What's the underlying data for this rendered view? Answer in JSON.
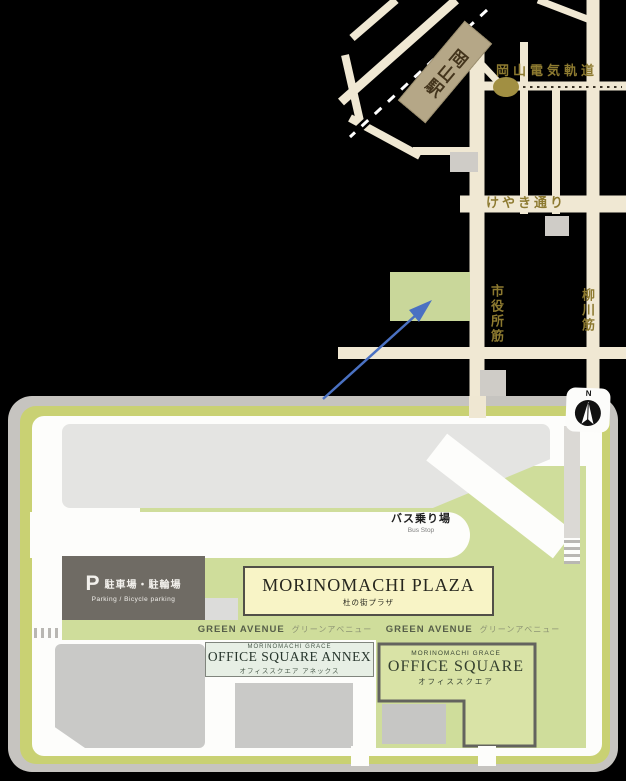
{
  "street_map": {
    "station": "岡山駅",
    "tram_label": "岡山電気軌道",
    "keyaki_street": "けやき通り",
    "shiyakusho_street": "市役所筋",
    "yanagawa_street": "柳川筋"
  },
  "site_map": {
    "bus_stop_jp": "バス乗り場",
    "bus_stop_en": "Bus Stop",
    "parking_mark": "P",
    "parking_jp": "駐車場・駐輪場",
    "parking_en": "Parking / Bicycle parking",
    "plaza_en": "MORINOMACHI PLAZA",
    "plaza_jp": "杜の街プラザ",
    "green_avenue_en": "GREEN AVENUE",
    "green_avenue_jp": "グリーンアベニュー",
    "grace_brand": "MORINOMACHI GRACE",
    "annex_en": "OFFICE SQUARE ANNEX",
    "annex_jp": "オフィススクエア アネックス",
    "office_square_en": "OFFICE SQUARE",
    "office_square_jp": "オフィススクエア",
    "compass_n": "N"
  },
  "colors": {
    "road_beige": "#f0e8d3",
    "gold_text": "#8d7a30",
    "station_fill": "#b5a787",
    "site_green": "#cfdd9b",
    "ring_green": "#c9d173",
    "plaza_cream": "#f8f4c6",
    "parking_gray": "#6f6b64",
    "arrow_blue": "#4a71c2"
  }
}
